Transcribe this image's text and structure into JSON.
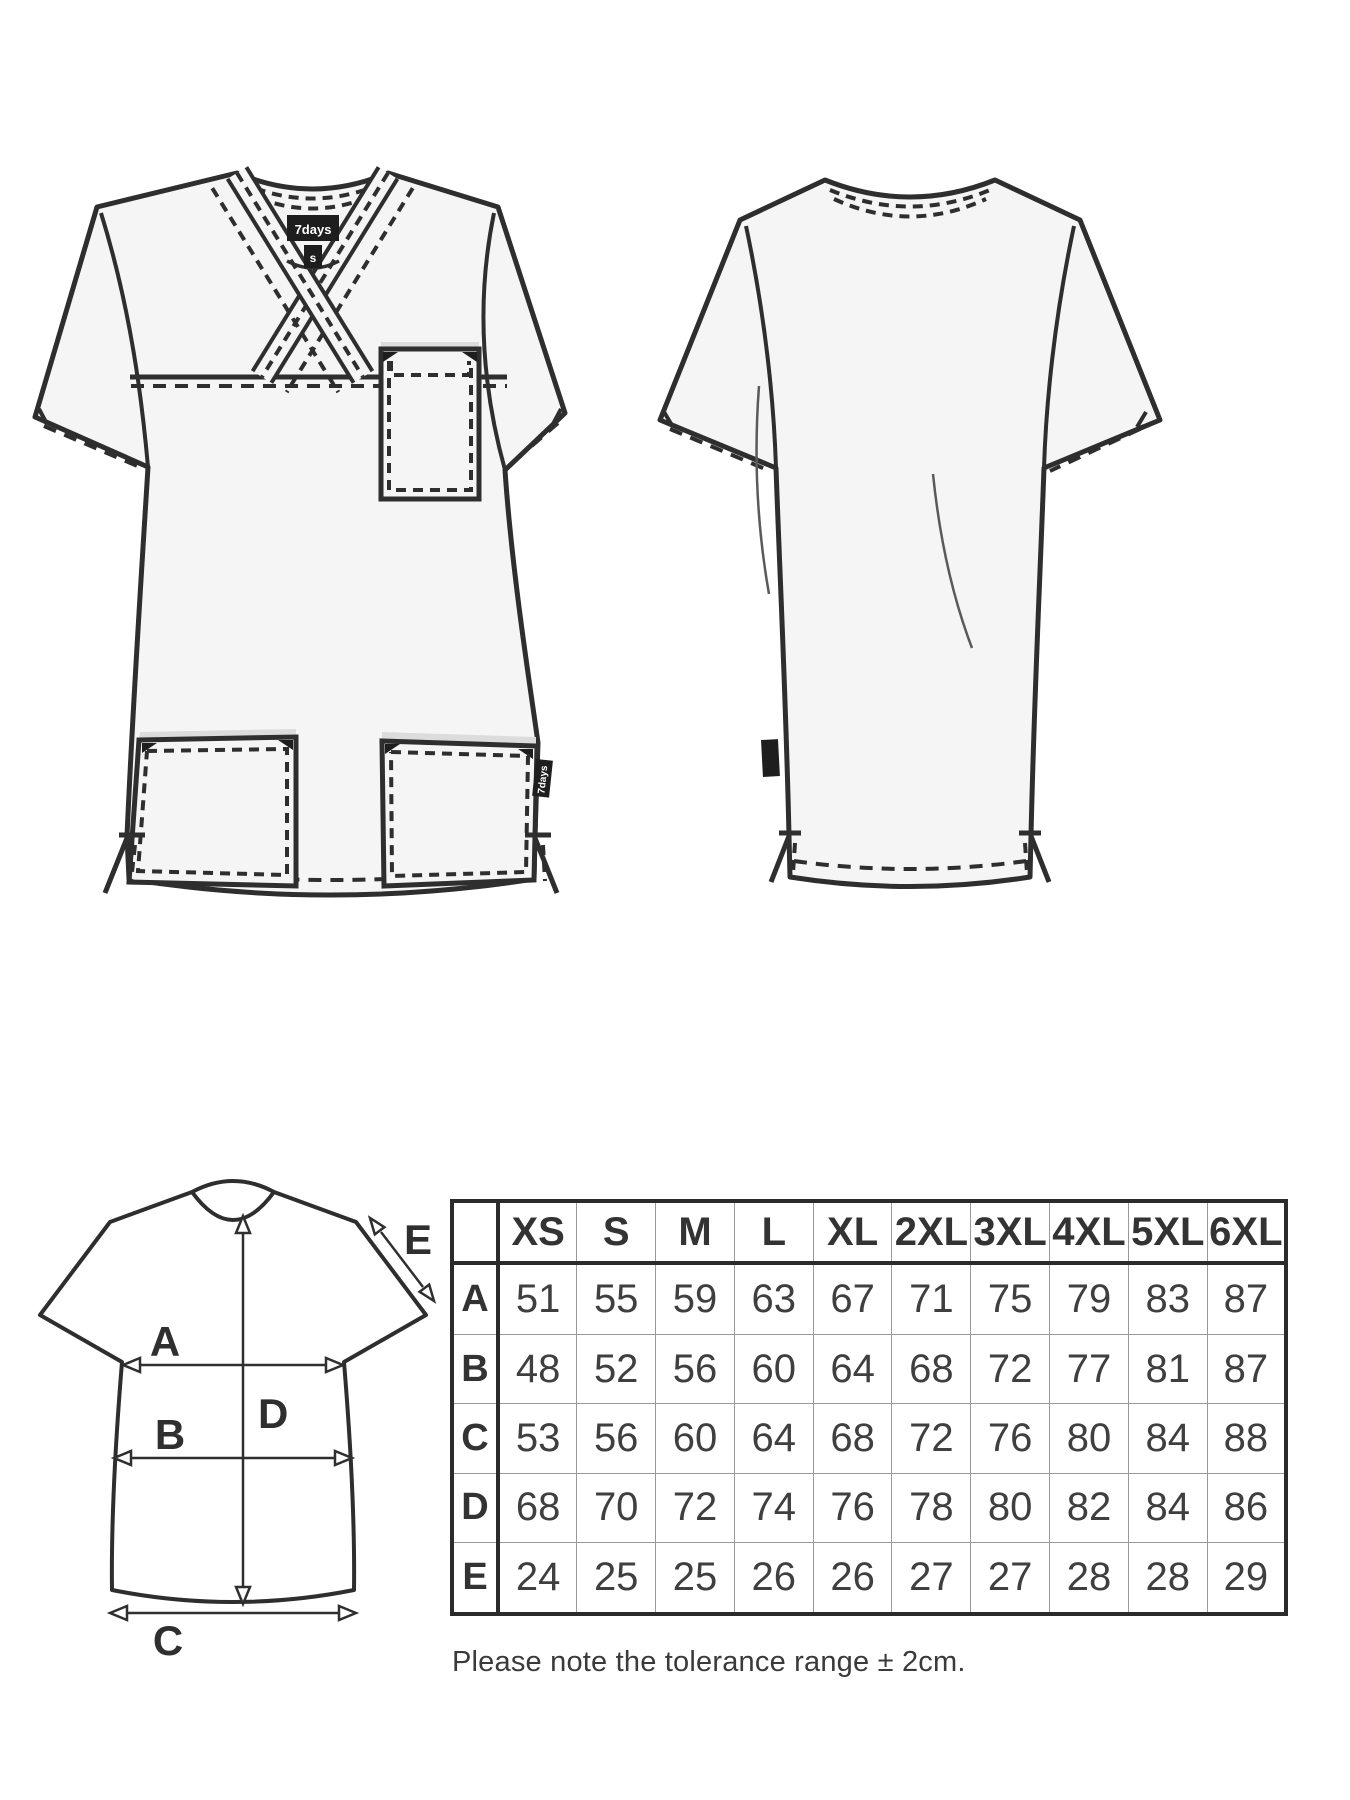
{
  "front_view": {
    "neck_label_brand": "7days",
    "neck_label_size": "s",
    "side_tag": "7days"
  },
  "back_view": {},
  "diagram": {
    "labels": {
      "A": "A",
      "B": "B",
      "C": "C",
      "D": "D",
      "E": "E"
    }
  },
  "size_table": {
    "columns": [
      "XS",
      "S",
      "M",
      "L",
      "XL",
      "2XL",
      "3XL",
      "4XL",
      "5XL",
      "6XL"
    ],
    "rows": [
      {
        "label": "A",
        "values": [
          "51",
          "55",
          "59",
          "63",
          "67",
          "71",
          "75",
          "79",
          "83",
          "87"
        ]
      },
      {
        "label": "B",
        "values": [
          "48",
          "52",
          "56",
          "60",
          "64",
          "68",
          "72",
          "77",
          "81",
          "87"
        ]
      },
      {
        "label": "C",
        "values": [
          "53",
          "56",
          "60",
          "64",
          "68",
          "72",
          "76",
          "80",
          "84",
          "88"
        ]
      },
      {
        "label": "D",
        "values": [
          "68",
          "70",
          "72",
          "74",
          "76",
          "78",
          "80",
          "82",
          "84",
          "86"
        ]
      },
      {
        "label": "E",
        "values": [
          "24",
          "25",
          "25",
          "26",
          "26",
          "27",
          "27",
          "28",
          "28",
          "29"
        ]
      }
    ]
  },
  "note": {
    "text": "Please note the tolerance range ± 2cm."
  },
  "colors": {
    "fabric": "#f5f5f5",
    "outline": "#2e2e2e",
    "tag_background": "#1e1e1e",
    "tag_text": "#ffffff",
    "pocket_shadow": "#dcdcdc",
    "table_border": "#2b2b2b",
    "table_gridline": "#9a9a9a",
    "text": "#3a3a3a"
  },
  "chart_data": {
    "type": "table",
    "columns": [
      "XS",
      "S",
      "M",
      "L",
      "XL",
      "2XL",
      "3XL",
      "4XL",
      "5XL",
      "6XL"
    ],
    "row_labels": [
      "A",
      "B",
      "C",
      "D",
      "E"
    ],
    "values": [
      [
        51,
        55,
        59,
        63,
        67,
        71,
        75,
        79,
        83,
        87
      ],
      [
        48,
        52,
        56,
        60,
        64,
        68,
        72,
        77,
        81,
        87
      ],
      [
        53,
        56,
        60,
        64,
        68,
        72,
        76,
        80,
        84,
        88
      ],
      [
        68,
        70,
        72,
        74,
        76,
        78,
        80,
        82,
        84,
        86
      ],
      [
        24,
        25,
        25,
        26,
        26,
        27,
        27,
        28,
        28,
        29
      ]
    ],
    "note": "Please note the tolerance range ± 2cm."
  }
}
